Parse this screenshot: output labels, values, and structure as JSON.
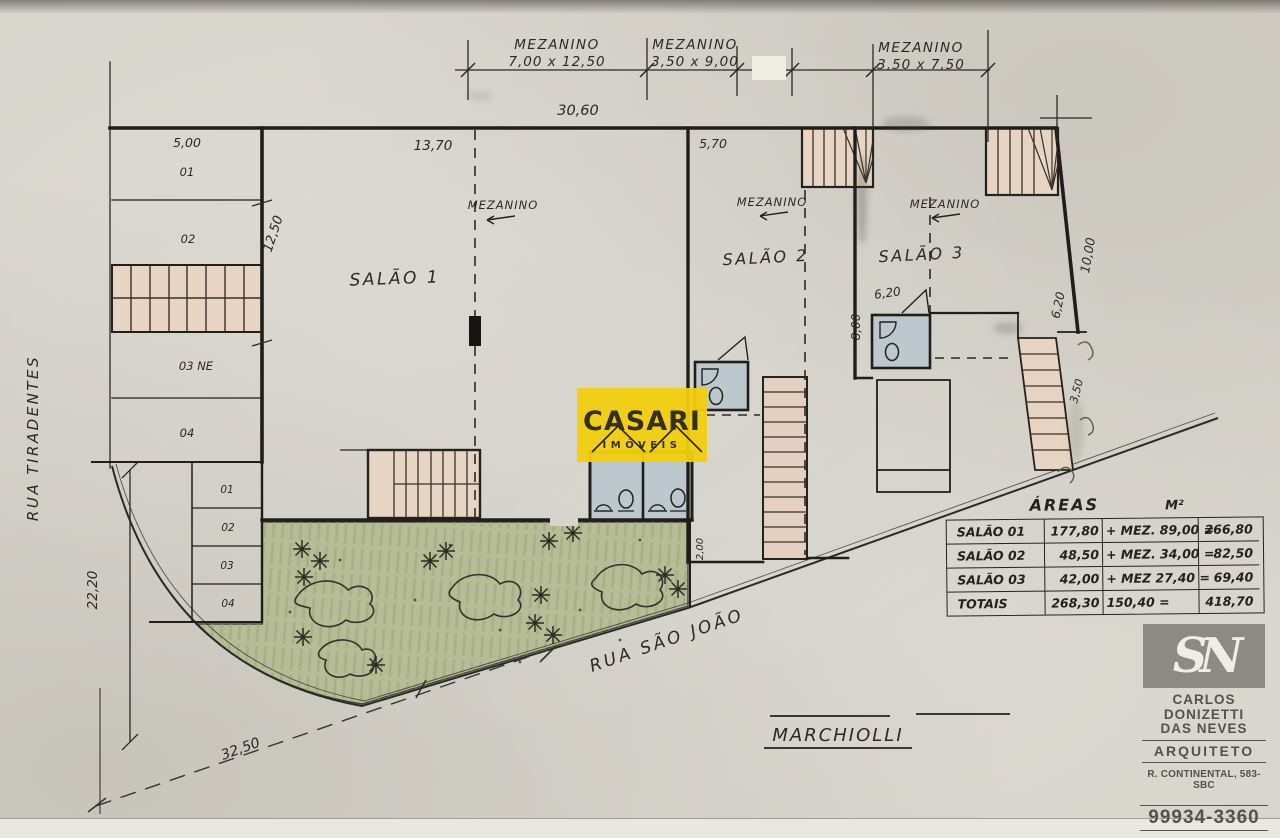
{
  "plan": {
    "streets": {
      "left": "RUA TIRADENTES",
      "diagonal": "RUA SÃO JOÃO"
    },
    "rooms": [
      "SALÃO 1",
      "SALÃO 2",
      "SALÃO 3"
    ],
    "mezzanine_note": "MEZANINO",
    "top_dims": [
      {
        "label": "MEZANINO",
        "size": "7,00 x 12,50"
      },
      {
        "label": "MEZANINO",
        "size": "3,50 x 9,00"
      },
      {
        "label": "MEZANINO",
        "size": "3,50 x 7,50"
      }
    ],
    "dims": {
      "total_width": "30,60",
      "left_top": "5,00",
      "salao1_width": "13,70",
      "salao2_width": "5,70",
      "left_height": "12,50",
      "left_lower_height": "22,20",
      "diagonal": "32,50",
      "salao3_bath_width": "6,20",
      "salao3_bath_height": "8,00",
      "right_wall_a": "10,00",
      "right_wall_b": "6,20",
      "ramp": "3,50",
      "garden_edge": "2,00"
    },
    "parking_upper": [
      "01",
      "02",
      "03 NE",
      "04"
    ],
    "parking_lower": [
      "01",
      "02",
      "03",
      "04"
    ]
  },
  "areas_table": {
    "title": "ÁREAS",
    "unit": "M²",
    "rows": [
      {
        "label": "SALÃO 01",
        "area": "177,80",
        "mez": "+ MEZ. 89,00 =",
        "total": "266,80"
      },
      {
        "label": "SALÃO 02",
        "area": "48,50",
        "mez": "+ MEZ. 34,00 =",
        "total": "82,50"
      },
      {
        "label": "SALÃO 03",
        "area": "42,00",
        "mez": "+ MEZ 27,40 =",
        "total": "69,40"
      },
      {
        "label": "TOTAIS",
        "area": "268,30",
        "mez": "150,40 =",
        "total": "418,70"
      }
    ]
  },
  "watermark": {
    "name": "CASARI",
    "subtitle": "IMÓVEIS",
    "bg": "#F2CF0C",
    "text": "#33301E"
  },
  "signature": "MARCHIOLLI",
  "stamp": {
    "monogram": "SN",
    "name_line1": "CARLOS",
    "name_line2": "DONIZETTI",
    "name_line3": "DAS NEVES",
    "role": "ARQUITETO",
    "address": "R. CONTINENTAL, 583-SBC",
    "phone": "99934-3360"
  },
  "colors": {
    "paper": "#D7D4CC",
    "ink": "#23221C",
    "garden": "#B6BC95",
    "stair_fill": "#E7D4C2",
    "bath_fill": "#BCC8CE",
    "stamp_ink": "#4E4B44"
  }
}
